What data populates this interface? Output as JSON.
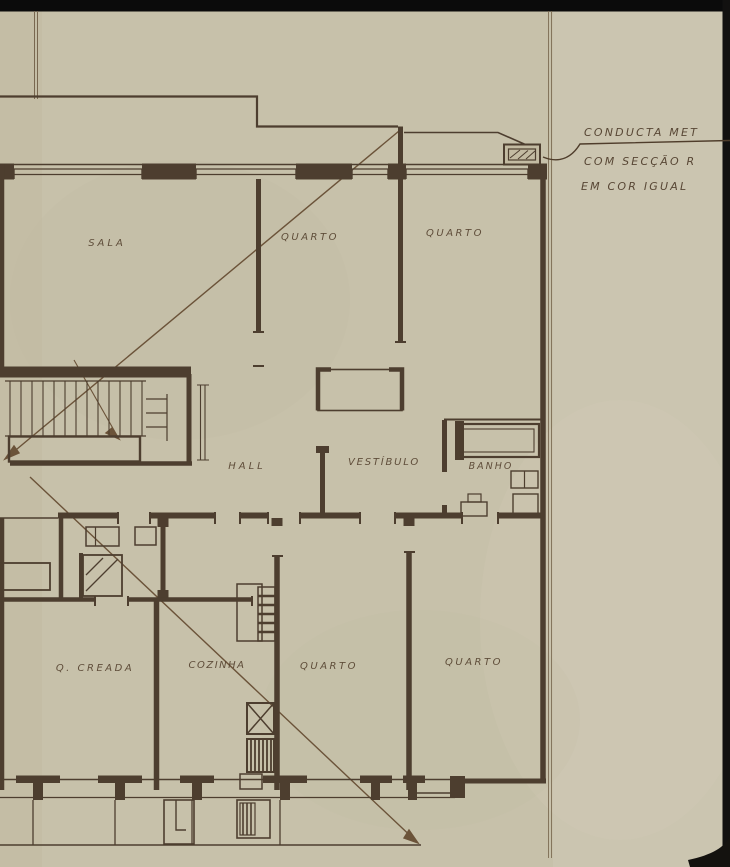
{
  "sheet": {
    "annotation": {
      "line1": "CONDUCTA MET",
      "line2": "COM SECÇÃO R",
      "line3": "EM COR IGUAL"
    },
    "rooms": {
      "sala": "SALA",
      "quarto_top_left": "QUARTO",
      "quarto_top_right": "QUARTO",
      "hall": "HALL",
      "vestibulo": "VESTÍBULO",
      "banho": "BANHO",
      "quarto_creada": "Q. CREADA",
      "cozinha": "COZINHA",
      "quarto_bottom_left": "QUARTO",
      "quarto_bottom_right": "QUARTO"
    },
    "colors": {
      "paper": "#c7c1aa",
      "paper_light": "#cdc8b4",
      "ink": "#4d3e2f",
      "ink_light": "#6b5a44",
      "crease": "#6b5339",
      "scan_black": "#0b0b0b"
    }
  }
}
